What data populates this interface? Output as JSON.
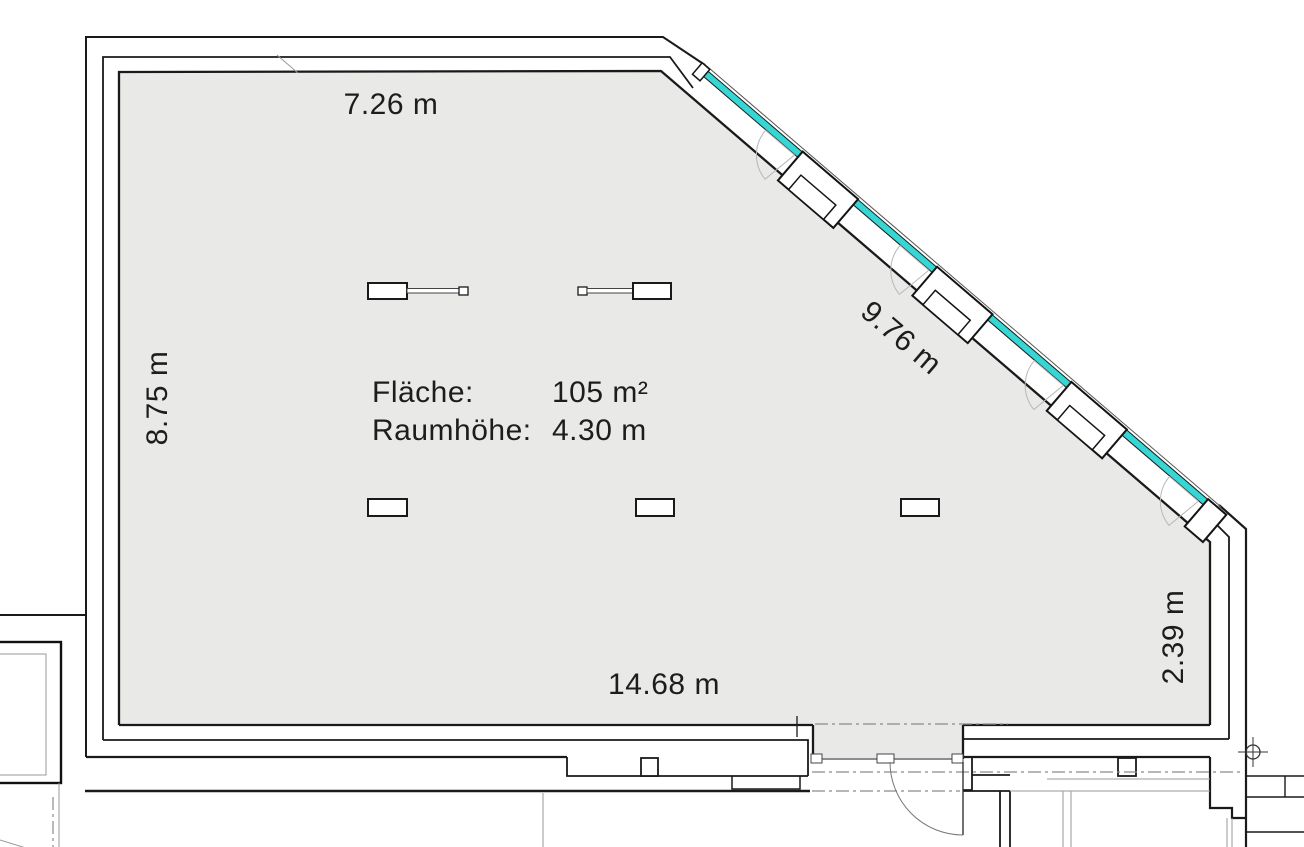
{
  "plan": {
    "dimensions": {
      "top": "7.26 m",
      "left": "8.75 m",
      "diagonal": "9.76 m",
      "right": "2.39 m",
      "bottom": "14.68 m"
    },
    "info": {
      "area_label": "Fläche:",
      "area_value": "105 m²",
      "height_label": "Raumhöhe:",
      "height_value": "4.30 m"
    },
    "colors": {
      "floor": "#e9e9e8",
      "glass": "#35d6d4",
      "line": "#1a1a1a"
    }
  }
}
